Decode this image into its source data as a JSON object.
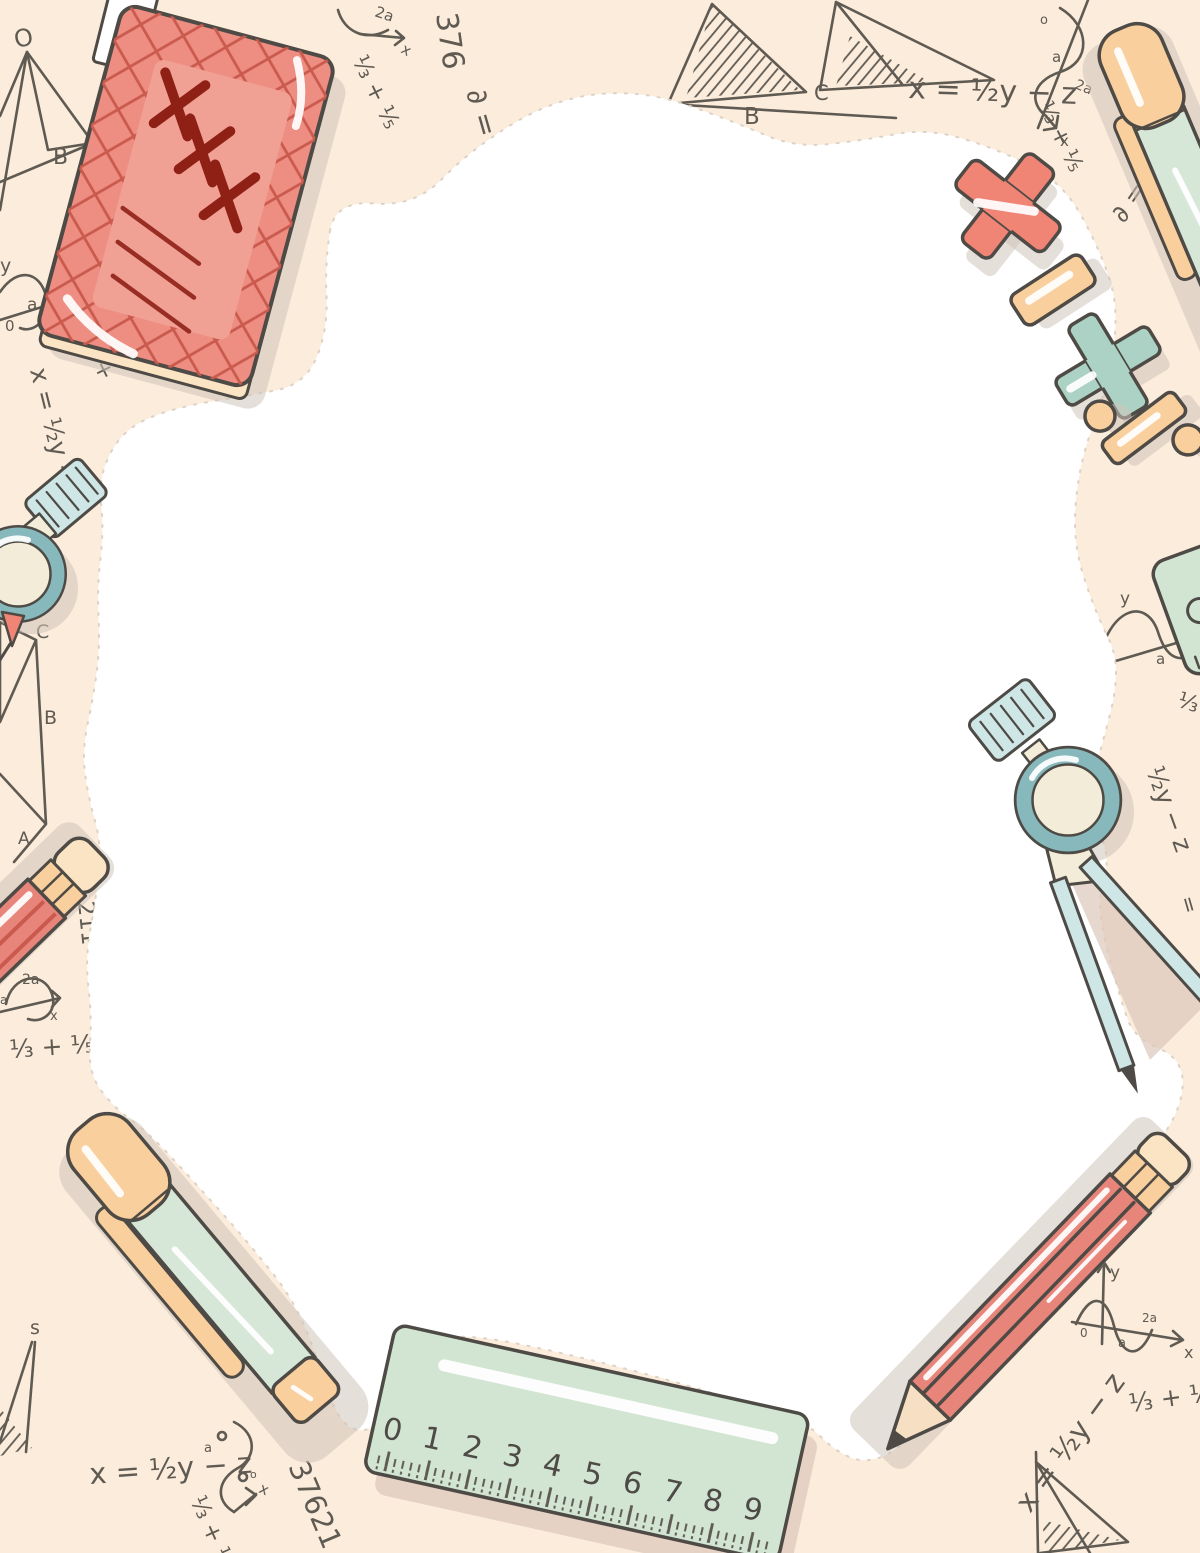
{
  "palette": {
    "bg": "#fbecdc",
    "white": "#ffffff",
    "blob": "#ffffff",
    "outline": "#4e4a45",
    "ink": "#5f5a52",
    "shadow": "#cfc5b9",
    "shadowPink": "#ddc8ba",
    "salmon": "#ee8e82",
    "salmonLight": "#f1a094",
    "hatchRed": "#ca5a4e",
    "xmark": "#8e2016",
    "red": "#f08475",
    "pencilRed": "#e8857b",
    "cream": "#f8cf9d",
    "creamLight": "#fbe4c4",
    "mint": "#d6e7d8",
    "mintRuler": "#d2e5d3",
    "teal": "#abd2c4",
    "tealCompass": "#87b8bc",
    "tealLight": "#cfe6e6",
    "paleCream": "#f2ecd8",
    "wood": "#f7dfc4"
  },
  "texts": {
    "xyz": "x = ½y − z",
    "frac": "⅓ + ⅕",
    "fracShort": "⅓ +",
    "third": "⅓",
    "halfYz": "½y − z",
    "power": "∂ = ²x ⅗",
    "vz": "∂ = z",
    "n37621": "37621",
    "n376": "376",
    "n211": "211",
    "eq": "=",
    "twoA": "2a",
    "x": "x",
    "y": "y",
    "a": "a",
    "o": "o",
    "zero": "0",
    "O": "O",
    "A": "A",
    "B": "B",
    "C": "C",
    "s": "s"
  },
  "notebook": {
    "cover_marks": "XXX"
  },
  "ruler": {
    "numbers": [
      "0",
      "1",
      "2",
      "3",
      "4",
      "5",
      "6",
      "7",
      "8",
      "9"
    ]
  },
  "illustration": {
    "items": [
      {
        "name": "notebook",
        "color": "#ee8e82"
      },
      {
        "name": "pen-top-right",
        "color": "#d6e7d8"
      },
      {
        "name": "pen-bottom-left",
        "color": "#d6e7d8"
      },
      {
        "name": "pencil-left",
        "color": "#e8857b"
      },
      {
        "name": "pencil-bottom-right",
        "color": "#e8857b"
      },
      {
        "name": "ruler",
        "color": "#d2e5d3"
      },
      {
        "name": "mini-ruler",
        "color": "#d2e5d3"
      },
      {
        "name": "compass-left",
        "color": "#87b8bc"
      },
      {
        "name": "compass-right",
        "color": "#87b8bc"
      },
      {
        "name": "plus-sign",
        "color": "#f08475"
      },
      {
        "name": "minus-sign",
        "color": "#f8cf9d"
      },
      {
        "name": "multiply-sign",
        "color": "#abd2c4"
      },
      {
        "name": "divide-sign",
        "color": "#f8cf9d"
      },
      {
        "name": "percent-divide-sign",
        "color": "#f8cf9d"
      }
    ]
  }
}
